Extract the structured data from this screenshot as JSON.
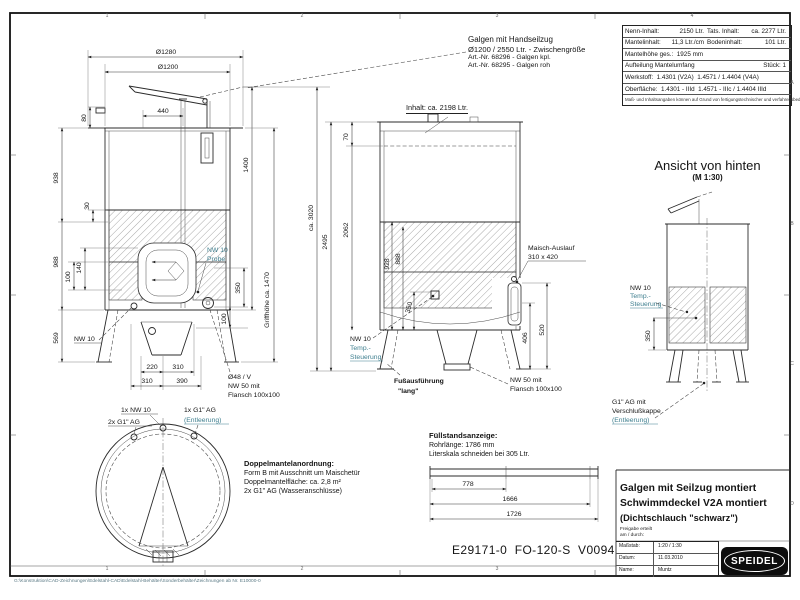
{
  "frame": {
    "zones": [
      "1",
      "2",
      "3",
      "4"
    ],
    "rows": [
      "A",
      "B",
      "C",
      "D"
    ],
    "footer_path": "G:\\Konstruktion\\CAD-Zeichnungen\\Edelstahl-CAD\\Edelstahl-Behälter\\Sonderbehälter\\Zeichnungen ab Nr. E10000-0"
  },
  "spec_table": {
    "nenn_label": "Nenn-Inhalt:",
    "nenn_value": "2150 Ltr.",
    "tats_label": "Tats. Inhalt:",
    "tats_value": "ca. 2277 Ltr.",
    "mantelinhalt_label": "Mantelinhalt:",
    "mantelinhalt_value": "11,3 Ltr./cm",
    "boden_label": "Bodeninhalt:",
    "boden_value": "101 Ltr.",
    "mantelhoehe": "Mantelhöhe ges.:  1925 mm",
    "aufteilung": "Aufteilung Mantelumfang",
    "stueck": "Stück: 1",
    "werkstoff": "Werkstoff:  1.4301 (V2A)  1.4571 / 1.4404 (V4A)",
    "oberflaeche": "Oberfläche:  1.4301 - IIId  1.4571 - IIIc / 1.4404 IIId",
    "note": "Maß- und Inhaltsangaben können auf Grund von fertigungstechnischer und verfahrensbedingter Toleranzen abweichen."
  },
  "galgen_note": {
    "line1": "Galgen mit Handseilzug",
    "line2": "Ø1200 / 2550 Ltr. - Zwischengröße",
    "line3": "Art.-Nr. 68296 - Galgen kpl.",
    "line4": "Art.-Nr. 68295 - Galgen roh"
  },
  "front_view": {
    "d1280": "Ø1280",
    "d1200": "Ø1200",
    "d440": "440",
    "d80": "80",
    "d30": "30",
    "d140": "140",
    "d100a": "100",
    "d938": "938",
    "d988": "988",
    "d569": "569",
    "d1400": "1400",
    "d350": "350",
    "d100b": "100",
    "griffhoehe": "Griffhöhe ca. 1470",
    "nw10": "NW 10",
    "probe1": "NW 10",
    "probe2": "Probe",
    "d220": "220",
    "d310a": "310",
    "d310b": "310",
    "d390": "390",
    "o48": "Ø48 / V",
    "nw50a": "NW 50 mit",
    "nw50b": "Flansch 100x100"
  },
  "top_view": {
    "l1": "1x NW 10",
    "l2": "2x G1\" AG",
    "l3": "1x G1\" AG",
    "l4": "(Entleerung)"
  },
  "side_view": {
    "inhalt": "Inhalt: ca. 2198 Ltr.",
    "ca3020": "ca. 3020",
    "d2495": "2495",
    "d2062": "2062",
    "d70": "70",
    "d928": "928",
    "d888": "888",
    "d350": "350",
    "maisch1": "Maisch-Auslauf",
    "maisch2": "310 x 420",
    "d406": "406",
    "d520": "520",
    "nw50a": "NW 50 mit",
    "nw50b": "Flansch 100x100",
    "nw10": "NW 10",
    "temp1": "Temp.-",
    "temp2": "Steuerung",
    "fuss1": "Fußausführung",
    "fuss2": "\"lang\""
  },
  "rear_view": {
    "title": "Ansicht von hinten",
    "scale": "(M 1:30)",
    "nw10": "NW 10",
    "temp1": "Temp.-",
    "temp2": "Steuerung",
    "d350": "350",
    "g1a": "G1\" AG mit",
    "g1b": "Verschlußkappe",
    "g1c": "(Entleerung)"
  },
  "doppelmantel": {
    "title": "Doppelmantelanordnung:",
    "line1": "Form B mit Ausschnitt um Maischetür",
    "line2": "Doppelmantelfläche: ca. 2,8 m²",
    "line3": "2x G1\" AG (Wasseranschlüsse)"
  },
  "fuellstand": {
    "title": "Füllstandsanzeige:",
    "line1": "Rohrlänge: 1786 mm",
    "line2": "Literskala schneiden bei 305 Ltr.",
    "d778": "778",
    "d1666": "1666",
    "d1726": "1726"
  },
  "title_block": {
    "line1": "Galgen mit Seilzug montiert",
    "line2": "Schwimmdeckel V2A montiert",
    "line3": "(Dichtschlauch \"schwarz\")",
    "freigabe1": "Freigabe erteilt",
    "freigabe2": "am / durch:",
    "massstab_label": "Maßstab:",
    "massstab_value": "1:20 / 1:30",
    "datum_label": "Datum:",
    "datum_value": "11.03.2010",
    "name_label": "Name:",
    "name_value": "Muntz",
    "logo": "SPEIDEL"
  },
  "drawing_number": "E29171-0  FO-120-S  V0094"
}
